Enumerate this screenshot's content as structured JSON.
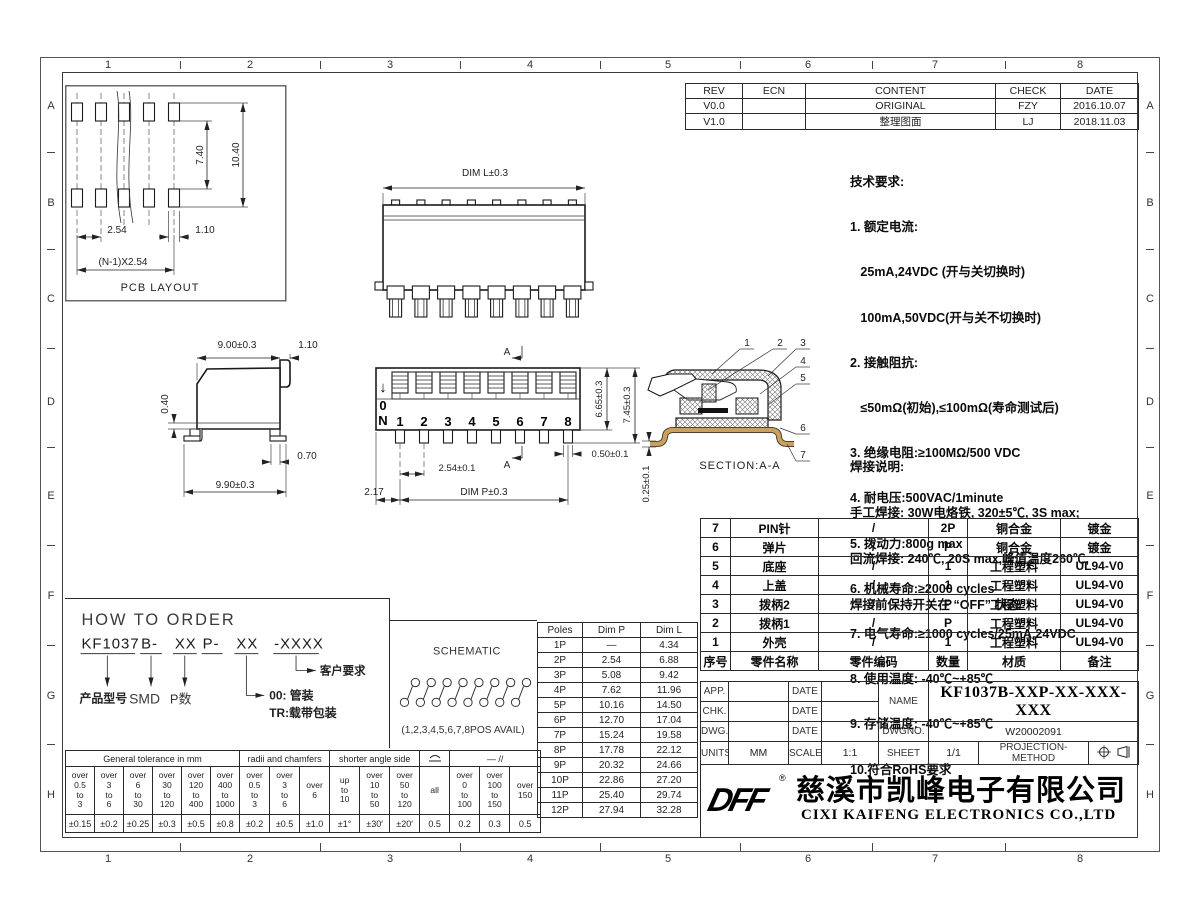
{
  "border": {
    "col_labels": [
      "1",
      "2",
      "3",
      "4",
      "5",
      "6",
      "7",
      "8"
    ],
    "row_labels": [
      "A",
      "B",
      "C",
      "D",
      "E",
      "F",
      "G",
      "H"
    ]
  },
  "revision_table": {
    "headers": [
      "REV",
      "ECN",
      "CONTENT",
      "CHECK",
      "DATE"
    ],
    "rows": [
      [
        "V0.0",
        "",
        "ORIGINAL",
        "FZY",
        "2016.10.07"
      ],
      [
        "V1.0",
        "",
        "整理图面",
        "LJ",
        "2018.11.03"
      ]
    ]
  },
  "tech_req": {
    "title": "技术要求:",
    "lines": [
      "1. 额定电流:",
      "   25mA,24VDC (开与关切换时)",
      "   100mA,50VDC(开与关不切换时)",
      "2. 接触阻抗:",
      "   ≤50mΩ(初始),≤100mΩ(寿命测试后)",
      "3. 绝缘电阻:≥100MΩ/500 VDC",
      "4. 耐电压:500VAC/1minute",
      "5. 拨动力:800g max",
      "6. 机械寿命:≥2000 cycles",
      "7. 电气寿命:≥1000 cycles/25mA,24VDC",
      "8. 使用温度: -40℃~+85℃",
      "9. 存储温度: -40℃~+85℃",
      "10.符合RoHS要求"
    ]
  },
  "solder_note": {
    "title": "焊接说明:",
    "lines": [
      "手工焊接: 30W电烙铁, 320±5℃, 3S max;",
      "回流焊接: 240℃, 20S max,峰值温度260℃,",
      "焊接前保持开关在 “OFF” 状态"
    ]
  },
  "pcb_view": {
    "label": "PCB LAYOUT",
    "dim_row_gap": "7.40",
    "dim_total_h": "10.40",
    "dim_pitch": "2.54",
    "dim_pad_w": "1.10",
    "dim_total_w": "(N-1)X2.54"
  },
  "rear_view": {
    "dim_l": "DIM L±0.3"
  },
  "side_view": {
    "dim_body_w": "9.00±0.3",
    "dim_tab": "1.10",
    "dim_standoff": "0.40",
    "dim_foot": "0.70",
    "dim_total": "9.90±0.3"
  },
  "front_view": {
    "on_arrow": "↓",
    "on_zero": "0",
    "on_n": "N",
    "positions": [
      "1",
      "2",
      "3",
      "4",
      "5",
      "6",
      "7",
      "8"
    ],
    "dim_body_h": "6.65±0.3",
    "dim_total_h": "7.45±0.3",
    "dim_pin_w": "0.50±0.1",
    "dim_pitch": "2.54±0.1",
    "dim_edge": "2.17",
    "dim_p": "DIM P±0.3",
    "section_mark": "A"
  },
  "section_view": {
    "label": "SECTION:A-A",
    "dim_pin_t": "0.25±0.1",
    "callouts": [
      "1",
      "2",
      "3",
      "4",
      "5",
      "6",
      "7"
    ]
  },
  "how_to_order": {
    "title": "HOW TO ORDER",
    "code1": "KF1037",
    "code2": "B-",
    "code3": "XX",
    "code4": "P-",
    "code5": "XX",
    "code6": "-XXXX",
    "label_model": "产品型号",
    "label_smd": "SMD",
    "label_pcount": "P数",
    "label_tube": "00: 管装",
    "label_tape": "TR:载带包装",
    "label_customer": "客户要求"
  },
  "schematic": {
    "title": "SCHEMATIC",
    "note": "(1,2,3,4,5,6,7,8POS AVAIL)"
  },
  "poles_table": {
    "headers": [
      "Poles",
      "Dim P",
      "Dim L"
    ],
    "rows": [
      [
        "1P",
        "—",
        "4.34"
      ],
      [
        "2P",
        "2.54",
        "6.88"
      ],
      [
        "3P",
        "5.08",
        "9.42"
      ],
      [
        "4P",
        "7.62",
        "11.96"
      ],
      [
        "5P",
        "10.16",
        "14.50"
      ],
      [
        "6P",
        "12.70",
        "17.04"
      ],
      [
        "7P",
        "15.24",
        "19.58"
      ],
      [
        "8P",
        "17.78",
        "22.12"
      ],
      [
        "9P",
        "20.32",
        "24.66"
      ],
      [
        "10P",
        "22.86",
        "27.20"
      ],
      [
        "11P",
        "25.40",
        "29.74"
      ],
      [
        "12P",
        "27.94",
        "32.28"
      ]
    ]
  },
  "bom_table": {
    "headers": [
      "序号",
      "零件名称",
      "零件编码",
      "数量",
      "材质",
      "备注"
    ],
    "rows": [
      [
        "7",
        "PIN针",
        "/",
        "2P",
        "铜合金",
        "镀金"
      ],
      [
        "6",
        "弹片",
        "/",
        "P",
        "铜合金",
        "镀金"
      ],
      [
        "5",
        "底座",
        "/",
        "1",
        "工程塑料",
        "UL94-V0"
      ],
      [
        "4",
        "上盖",
        "/",
        "1",
        "工程塑料",
        "UL94-V0"
      ],
      [
        "3",
        "拨柄2",
        "/",
        "P",
        "工程塑料",
        "UL94-V0"
      ],
      [
        "2",
        "拨柄1",
        "/",
        "P",
        "工程塑料",
        "UL94-V0"
      ],
      [
        "1",
        "外壳",
        "/",
        "1",
        "工程塑料",
        "UL94-V0"
      ]
    ]
  },
  "title_block": {
    "app_label": "APP.",
    "chk_label": "CHK.",
    "dwg_label": "DWG.",
    "date_label": "DATE",
    "name_label": "NAME",
    "name_value": "KF1037B-XXP-XX-XXX-XXX",
    "dwgno_label": "DWGNO.",
    "dwgno_value": "W20002091",
    "units_label": "UNITS",
    "units_value": "MM",
    "scale_label": "SCALE",
    "scale_value": "1:1",
    "sheet_label": "SHEET",
    "sheet_value": "1/1",
    "projection_label": "PROJECTION-METHOD"
  },
  "company": {
    "logo": "DFF",
    "reg_mark": "®",
    "name_cn": "慈溪市凯峰电子有限公司",
    "name_en": "CIXI KAIFENG ELECTRONICS CO.,LTD"
  },
  "tolerance_table": {
    "group1": "General tolerance in mm",
    "group2": "radii and chamfers",
    "group3": "shorter angle side",
    "group5": "—  //",
    "ranges": [
      "over\n0.5\nto\n3",
      "over\n3\nto\n6",
      "over\n6\nto\n30",
      "over\n30\nto\n120",
      "over\n120\nto\n400",
      "over\n400\nto\n1000",
      "over\n0.5\nto\n3",
      "over\n3\nto\n6",
      "over\n6",
      "up\nto\n10",
      "over\n10\nto\n50",
      "over\n50\nto\n120",
      "all",
      "over\n0\nto\n100",
      "over\n100\nto\n150",
      "over\n150"
    ],
    "values": [
      "±0.15",
      "±0.2",
      "±0.25",
      "±0.3",
      "±0.5",
      "±0.8",
      "±0.2",
      "±0.5",
      "±1.0",
      "±1°",
      "±30′",
      "±20′",
      "0.5",
      "0.2",
      "0.3",
      "0.5"
    ]
  }
}
